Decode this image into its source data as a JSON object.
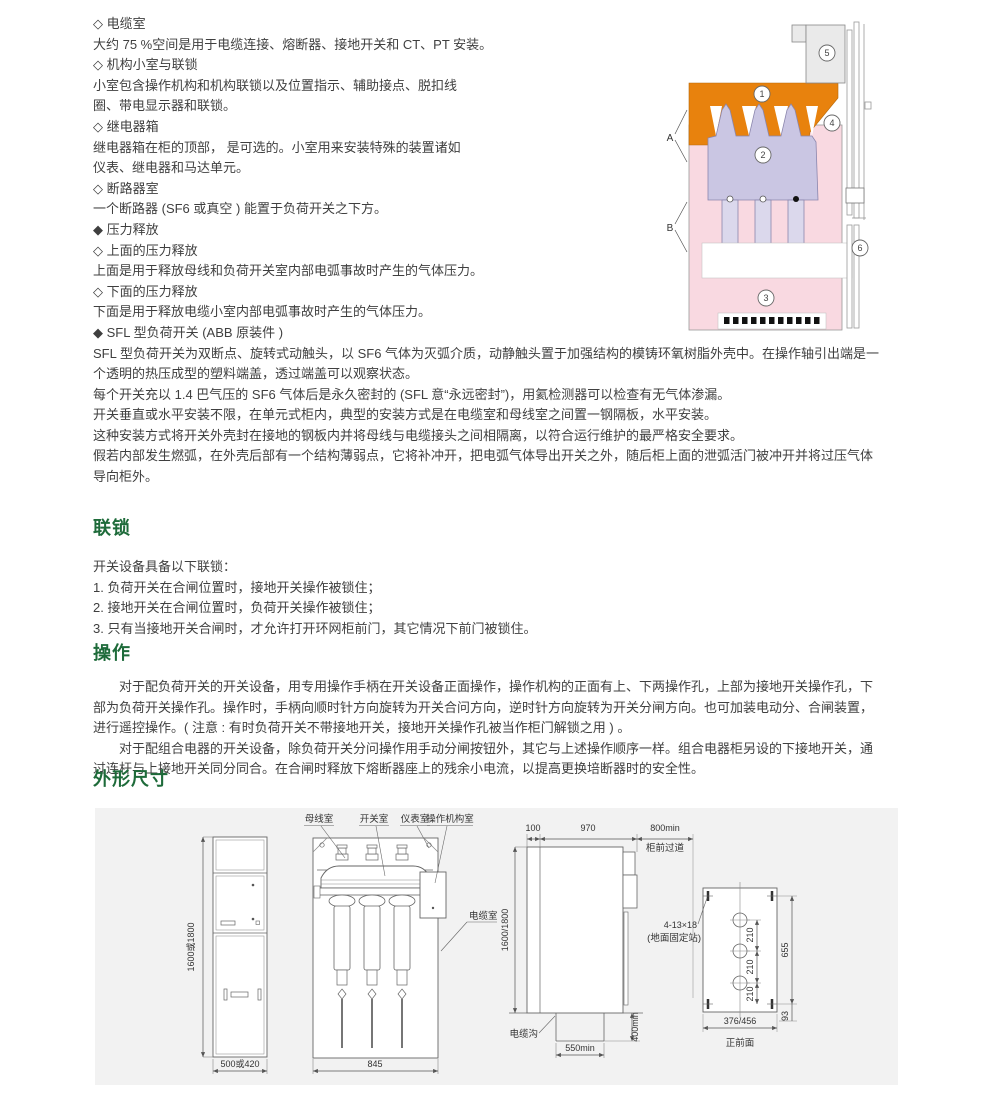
{
  "accent_green": "#1e6b3a",
  "intro_lines": [
    "◇ 电缆室",
    "大约 75 %空间是用于电缆连接、熔断器、接地开关和 CT、PT 安装。",
    "◇ 机构小室与联锁",
    "小室包含操作机构和机构联锁以及位置指示、辅助接点、脱扣线",
    "圈、带电显示器和联锁。",
    "◇ 继电器箱",
    "继电器箱在柜的顶部， 是可选的。小室用来安装特殊的装置诸如",
    "仪表、继电器和马达单元。",
    "◇ 断路器室",
    "一个断路器 (SF6 或真空 ) 能置于负荷开关之下方。",
    "◆ 压力释放",
    "◇ 上面的压力释放",
    "上面是用于释放母线和负荷开关室内部电弧事故时产生的气体压力。",
    "◇ 下面的压力释放",
    "下面是用于释放电缆小室内部电弧事故时产生的气体压力。",
    "◆ SFL 型负荷开关 (ABB 原装件 )",
    "SFL 型负荷开关为双断点、旋转式动触头，以 SF6 气体为灭弧介质，动静触头置于加强结构的模铸环氧树脂外壳中。在操作轴引出端是一",
    "个透明的热压成型的塑料端盖，透过端盖可以观察状态。",
    "每个开关充以 1.4 巴气压的 SF6 气体后是永久密封的 (SFL 意“永远密封”)，用氦检测器可以检查有无气体渗漏。",
    "开关垂直或水平安装不限，在单元式柜内，典型的安装方式是在电缆室和母线室之间置一钢隔板，水平安装。",
    "这种安装方式将开关外壳封在接地的钢板内并将母线与电缆接头之间相隔离，以符合运行维护的最严格安全要求。",
    "假若内部发生燃弧，在外壳后部有一个结构薄弱点，它将补冲开，把电弧气体导出开关之外，随后柜上面的泄弧活门被冲开并将过压气体",
    "导向柜外。"
  ],
  "sections": {
    "interlock": {
      "title": "联锁",
      "lines": [
        "开关设备具备以下联锁：",
        "1. 负荷开关在合闸位置时，接地开关操作被锁住；",
        "2. 接地开关在合闸位置时，负荷开关操作被锁住；",
        "3. 只有当接地开关合闸时，才允许打开环网柜前门，其它情况下前门被锁住。"
      ]
    },
    "operation": {
      "title": "操作",
      "lines": [
        "对于配负荷开关的开关设备，用专用操作手柄在开关设备正面操作，操作机构的正面有上、下两操作孔，上部为接地开关操作孔，下",
        "部为负荷开关操作孔。操作时，手柄向顺时针方向旋转为开关合问方向，逆时针方向旋转为开关分闸方向。也可加装电动分、合闸装置，",
        "进行遥控操作。( 注意 : 有时负荷开关不带接地开关，接地开关操作孔被当作柜门解锁之用 ) 。",
        "对于配组合电器的开关设备，除负荷开关分问操作用手动分闸按钮外，其它与上述操作顺序一样。组合电器柜另设的下接地开关，通",
        "过连杆与上接地开关同分同合。在合闸时释放下熔断器座上的残余小电流，以提高更换培断器时的安全性。"
      ]
    },
    "dimensions": {
      "title": "外形尺寸"
    }
  },
  "diagram": {
    "callouts": [
      "1",
      "2",
      "3",
      "4",
      "5",
      "6"
    ],
    "labels": {
      "a": "A",
      "b": "B"
    },
    "colors": {
      "busbar_room": "#e8820d",
      "switch_body": "#cac6e3",
      "cable_room": "#f9d9e1",
      "relay_box": "#eaeaea"
    }
  },
  "drawings": {
    "front_view": {
      "height_dim": "1600或1800",
      "width_dim": "500或420"
    },
    "section_view": {
      "room_labels": [
        "母线室",
        "开关室",
        "仪表室",
        "操作机构室"
      ],
      "cable_room_label": "电缆室",
      "width_dim": "845"
    },
    "side_view": {
      "dim_100": "100",
      "dim_970": "970",
      "dim_800": "800min",
      "aisle_label": "柜前过道",
      "height_dim": "1600/1800",
      "trench_label": "电缆沟",
      "dim_550": "550min",
      "dim_400": "400min"
    },
    "foundation_plan": {
      "holes_label": "4-13×18",
      "holes_note": "(地面固定站)",
      "dim_210": "210",
      "dim_655": "655",
      "dim_93": "93",
      "width_dim": "376/456",
      "caption": "正前面"
    }
  }
}
